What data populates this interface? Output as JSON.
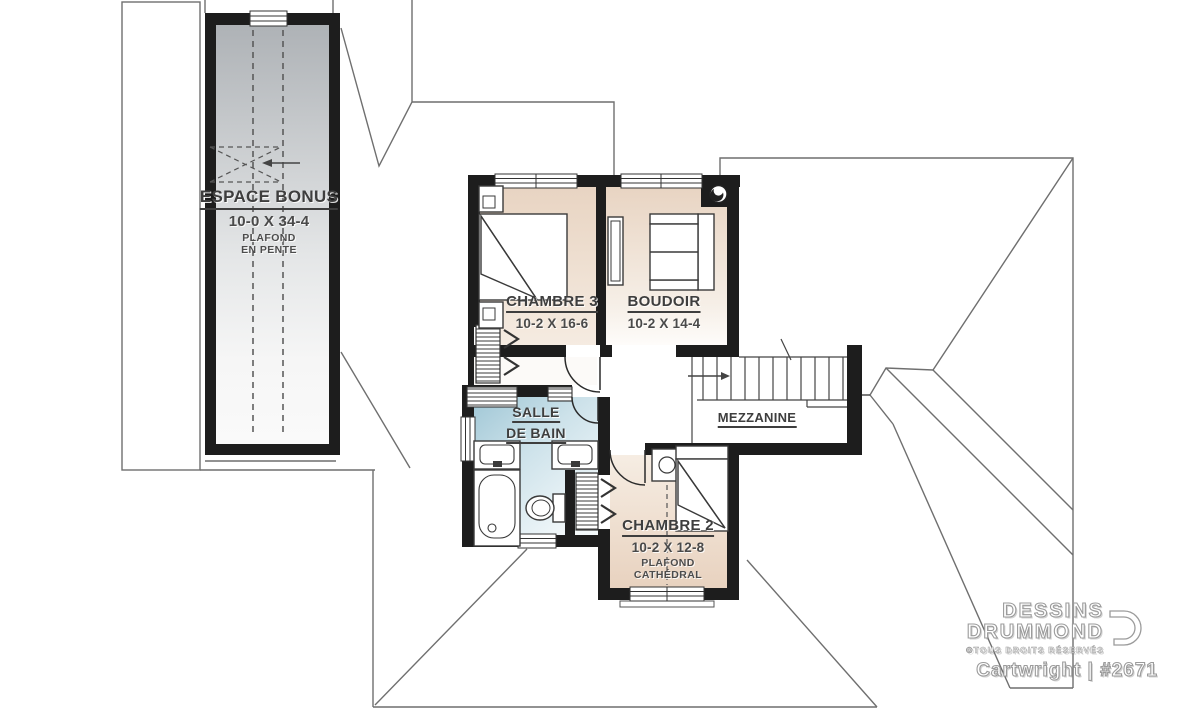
{
  "rooms": {
    "espace_bonus": {
      "name": "ESPACE BONUS",
      "dimensions": "10-0 X 34-4",
      "note_line1": "PLAFOND",
      "note_line2": "EN PENTE"
    },
    "chambre_3": {
      "name": "CHAMBRE 3",
      "dimensions": "10-2 X 16-6"
    },
    "boudoir": {
      "name": "BOUDOIR",
      "dimensions": "10-2 X 14-4"
    },
    "salle_de_bain": {
      "name_line1": "SALLE",
      "name_line2": "DE BAIN"
    },
    "mezzanine": {
      "name": "MEZZANINE"
    },
    "chambre_2": {
      "name": "CHAMBRE 2",
      "dimensions": "10-2 X 12-8",
      "note_line1": "PLAFOND",
      "note_line2": "CATHÉDRAL"
    }
  },
  "branding": {
    "company_line1": "DESSINS",
    "company_line2": "DRUMMOND",
    "rights": "©TOUS DROITS RÉSERVÉS",
    "plan_name": "Cartwright",
    "separator": "|",
    "plan_number": "#2671"
  },
  "colors": {
    "wall": "#1d1d1d",
    "roof_line": "#6f6f6f",
    "bedroom_fill": "#e8d4c2",
    "bathroom_fill": "#a0c7d6",
    "bonus_fill": "#aeb2b6",
    "label_text": "#3e3e3e"
  }
}
